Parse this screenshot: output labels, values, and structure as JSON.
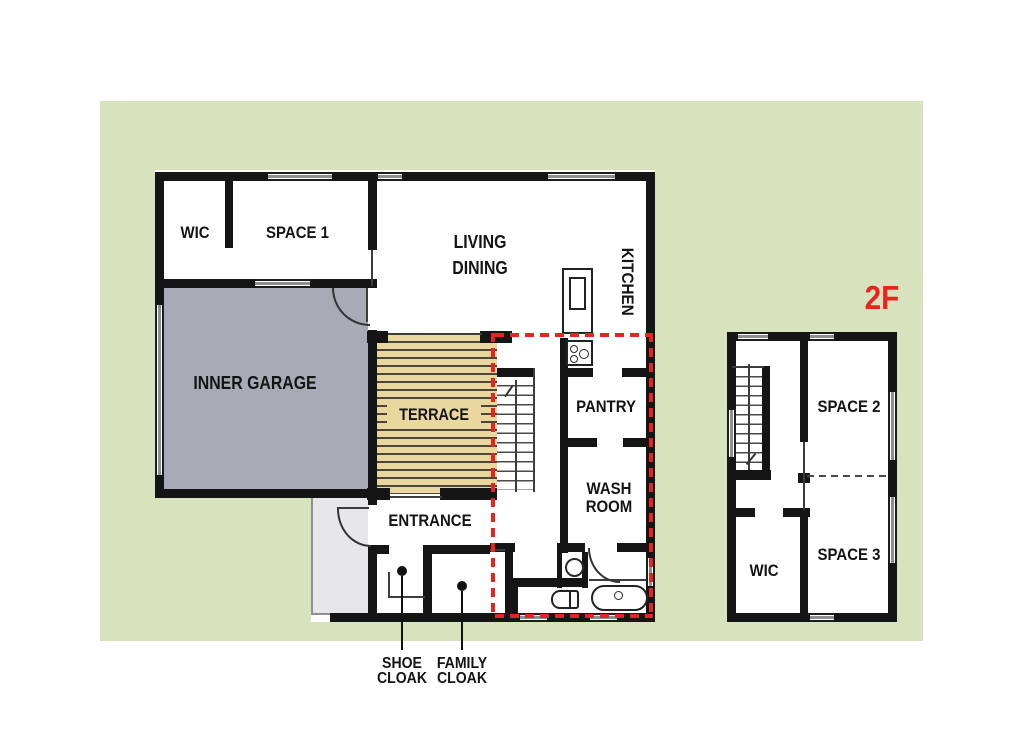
{
  "plan": {
    "floor1": {
      "rooms": {
        "wic": "WIC",
        "space1": "SPACE 1",
        "living_line1": "LIVING",
        "living_line2": "DINING",
        "kitchen": "KITCHEN",
        "inner_garage": "INNER GARAGE",
        "terrace": "TERRACE",
        "pantry": "PANTRY",
        "wash_line1": "WASH",
        "wash_line2": "ROOM",
        "entrance": "ENTRANCE"
      },
      "callouts": {
        "shoe_line1": "SHOE",
        "shoe_line2": "CLOAK",
        "family_line1": "FAMILY",
        "family_line2": "CLOAK"
      }
    },
    "floor2": {
      "tag": "2F",
      "rooms": {
        "space2": "SPACE 2",
        "space3": "SPACE 3",
        "wic": "WIC"
      }
    },
    "colors": {
      "site_green": "#d7e3bd",
      "wall_black": "#151515",
      "garage_gray": "#a8aab5",
      "porch_gray": "#e7e7e9",
      "terrace_tan": "#e9d79f",
      "terrace_stripe": "#4e4638",
      "zone_red": "#e8241f"
    }
  }
}
